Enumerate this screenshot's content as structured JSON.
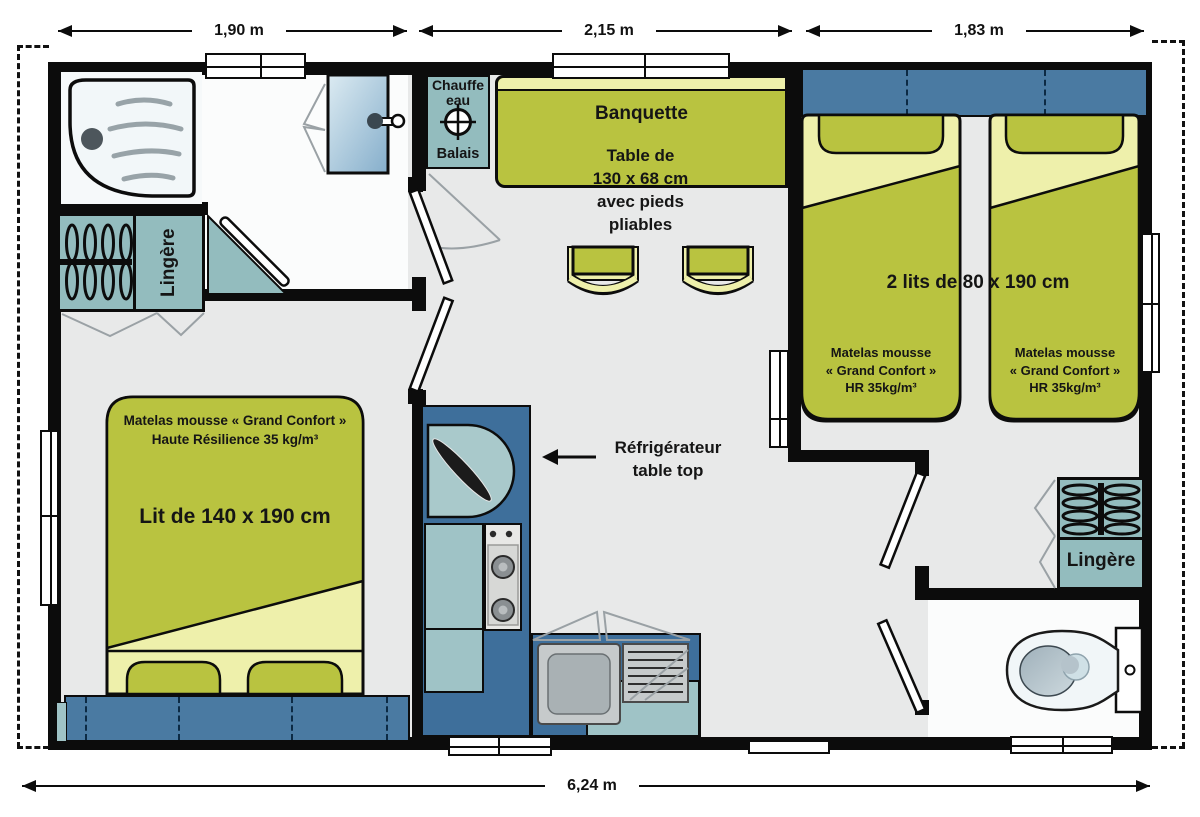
{
  "dimensions": {
    "top_left": "1,90 m",
    "top_center": "2,15 m",
    "top_right": "1,83 m",
    "overall": "6,24 m"
  },
  "utility": {
    "water_heater": "Chauffe\neau",
    "broom": "Balais"
  },
  "living": {
    "bench": "Banquette",
    "table": "Table de\n130 x 68 cm\navec pieds\npliables",
    "fridge": "Réfrigérateur\ntable top"
  },
  "twin_room": {
    "title": "2 lits de 80 x 190 cm",
    "mattress_left": "Matelas mousse\n« Grand Confort »\nHR 35kg/m³",
    "mattress_right": "Matelas mousse\n« Grand Confort »\nHR 35kg/m³"
  },
  "master_room": {
    "mattress": "Matelas mousse « Grand Confort »\nHaute Résilience 35 kg/m³",
    "bed": "Lit de 140 x 190 cm",
    "wardrobe": "Lingère"
  },
  "toilet_room": {
    "wardrobe": "Lingère"
  },
  "colors": {
    "furniture_green": "#b9c340",
    "sheet_cream": "#eef0ab",
    "closet_teal": "#93bcbe",
    "table_teal": "#8cbdc1",
    "counter_teal": "#9fc3c6",
    "headboard_blue": "#4a7aa2",
    "cabinet_blue": "#3e6f9b",
    "floor_grey": "#e8e9e9",
    "wall_black": "#0c0c0c"
  },
  "icons": {
    "shower": "shower-tray-icon",
    "washbasin": "washbasin-icon",
    "toilet": "toilet-icon",
    "hangers": "clothes-hangers-icon",
    "stove": "stove-burners-icon",
    "water_heater_symbol": "crosshair-icon",
    "fridge_pointer": "left-arrow-icon"
  }
}
